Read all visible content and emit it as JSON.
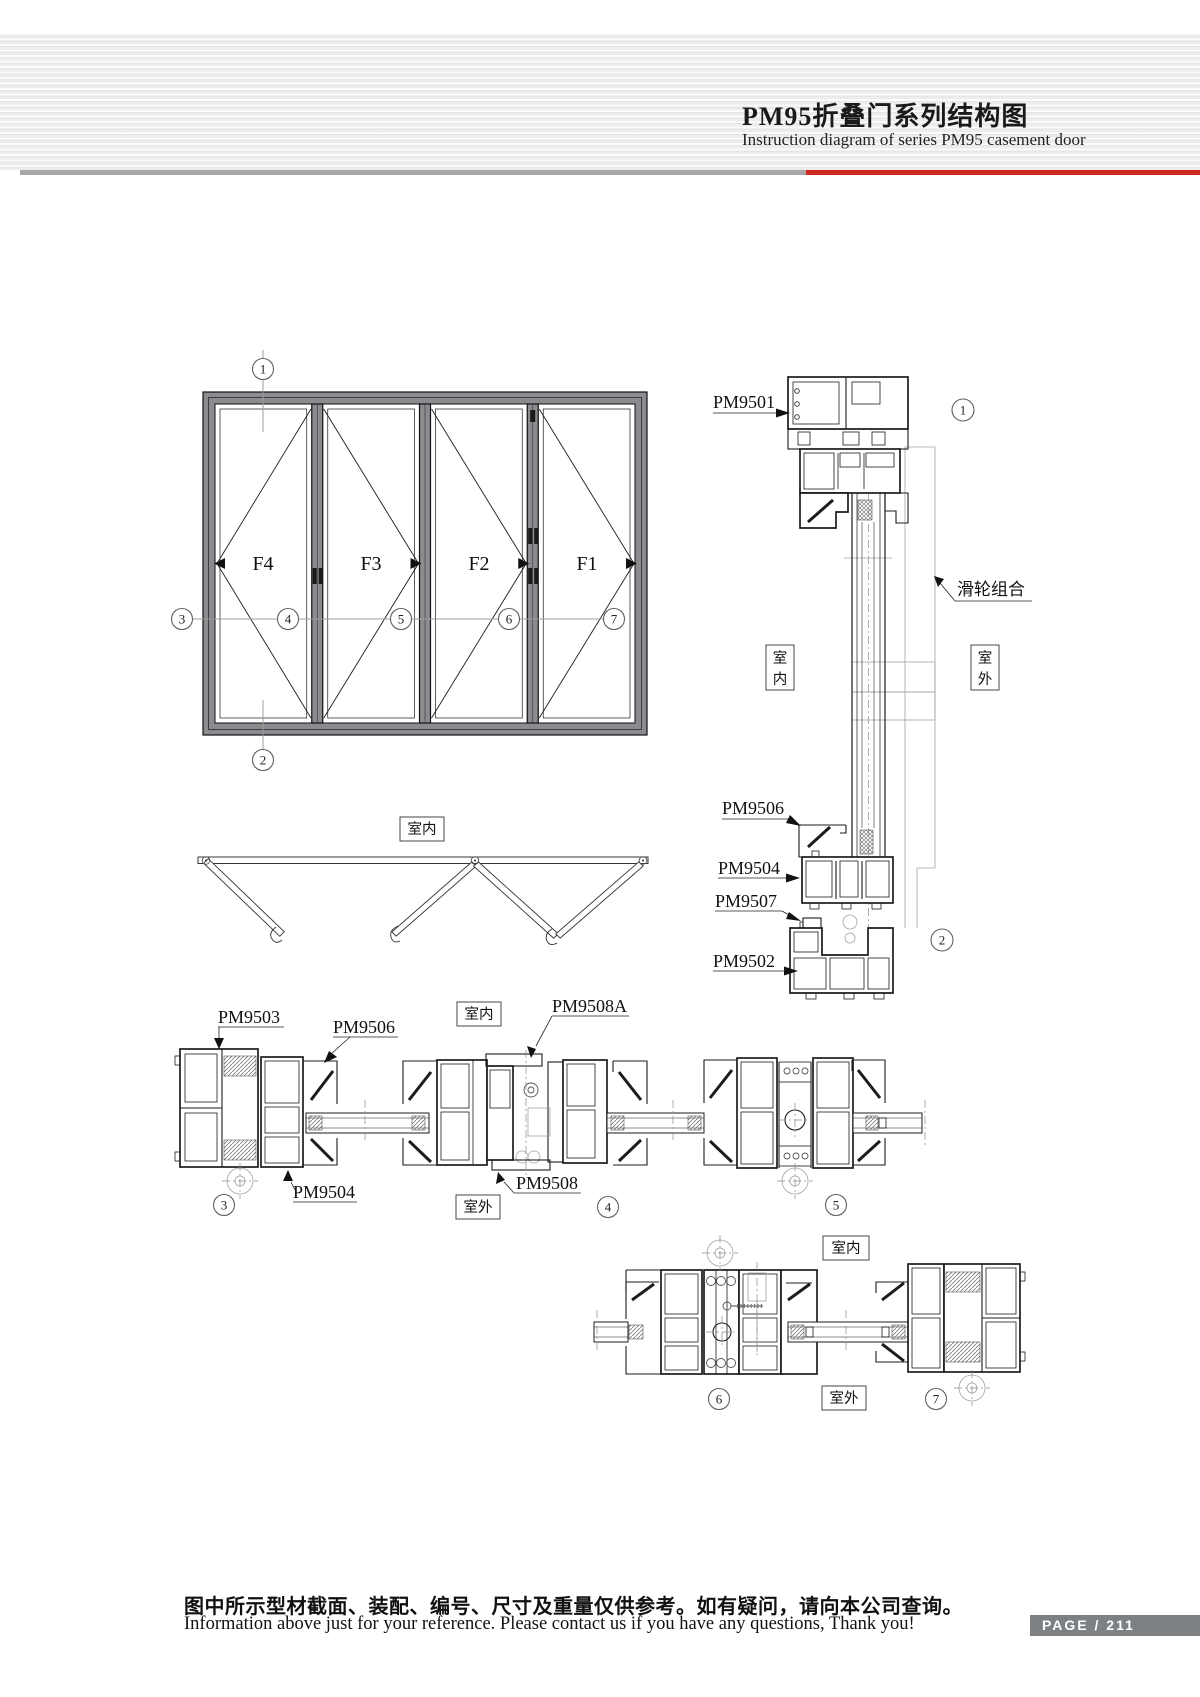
{
  "header": {
    "title_cn": "PM95折叠门系列结构图",
    "subtitle_en": "Instruction diagram of series PM95 casement door"
  },
  "colors": {
    "accent_red": "#cf2823",
    "divider_gray": "#a7a7a7",
    "badge_bg": "#7e8184",
    "frame_fill": "#8a8c8f",
    "line_dark": "#1c1c1c",
    "line_light": "#a3a3a3"
  },
  "elevation": {
    "panels": [
      {
        "label": "F4"
      },
      {
        "label": "F3"
      },
      {
        "label": "F2"
      },
      {
        "label": "F1"
      }
    ],
    "callout_top": "1",
    "callout_bottom": "2",
    "callouts_mid": [
      {
        "n": "3"
      },
      {
        "n": "4"
      },
      {
        "n": "5"
      },
      {
        "n": "6"
      },
      {
        "n": "7"
      }
    ]
  },
  "section_vertical": {
    "label_top": "PM9501",
    "labels_bottom": [
      {
        "text": "PM9506"
      },
      {
        "text": "PM9504"
      },
      {
        "text": "PM9507"
      },
      {
        "text": "PM9502"
      }
    ],
    "roller_label": "滑轮组合",
    "indoor_1": "室",
    "indoor_2": "内",
    "outdoor_1": "室",
    "outdoor_2": "外",
    "callout_top": "1",
    "callout_bottom": "2"
  },
  "plan": {
    "indoor": "室内"
  },
  "details_row1": {
    "indoor": "室内",
    "outdoor": "室外",
    "label_pm9503": "PM9503",
    "label_pm9506": "PM9506",
    "label_pm9504": "PM9504",
    "label_pm9508a": "PM9508A",
    "label_pm9508": "PM9508",
    "callouts": [
      {
        "n": "3"
      },
      {
        "n": "4"
      },
      {
        "n": "5"
      }
    ]
  },
  "details_row2": {
    "indoor": "室内",
    "outdoor": "室外",
    "callouts": [
      {
        "n": "6"
      },
      {
        "n": "7"
      }
    ]
  },
  "footer": {
    "note_cn": "图中所示型材截面、装配、编号、尺寸及重量仅供参考。如有疑问，请向本公司查询。",
    "note_en": "Information above just for your reference. Please contact us if you have any questions, Thank you!",
    "page_text": "PAGE / 211"
  }
}
